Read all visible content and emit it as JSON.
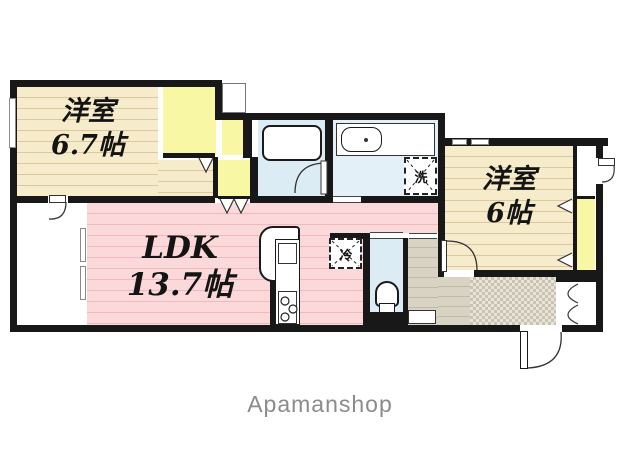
{
  "watermark": "Apamanshop",
  "rooms": {
    "bedroom1": {
      "name": "洋室",
      "size": "6.7帖"
    },
    "ldk": {
      "name": "LDK",
      "size": "13.7帖"
    },
    "bedroom2": {
      "name": "洋室",
      "size": "6帖"
    }
  },
  "fixtures": {
    "washer": "洗",
    "fridge": "冷"
  },
  "colors": {
    "wall": "#181818",
    "wood_floor": "#f6ebca",
    "ldk_floor": "#fbd9da",
    "closet": "#f8f7a3",
    "wet_area": "#dcecf5",
    "corridor": "#d9d3c3",
    "genkan": "#c9c3b4",
    "watermark_text": "#8b8b8b"
  }
}
